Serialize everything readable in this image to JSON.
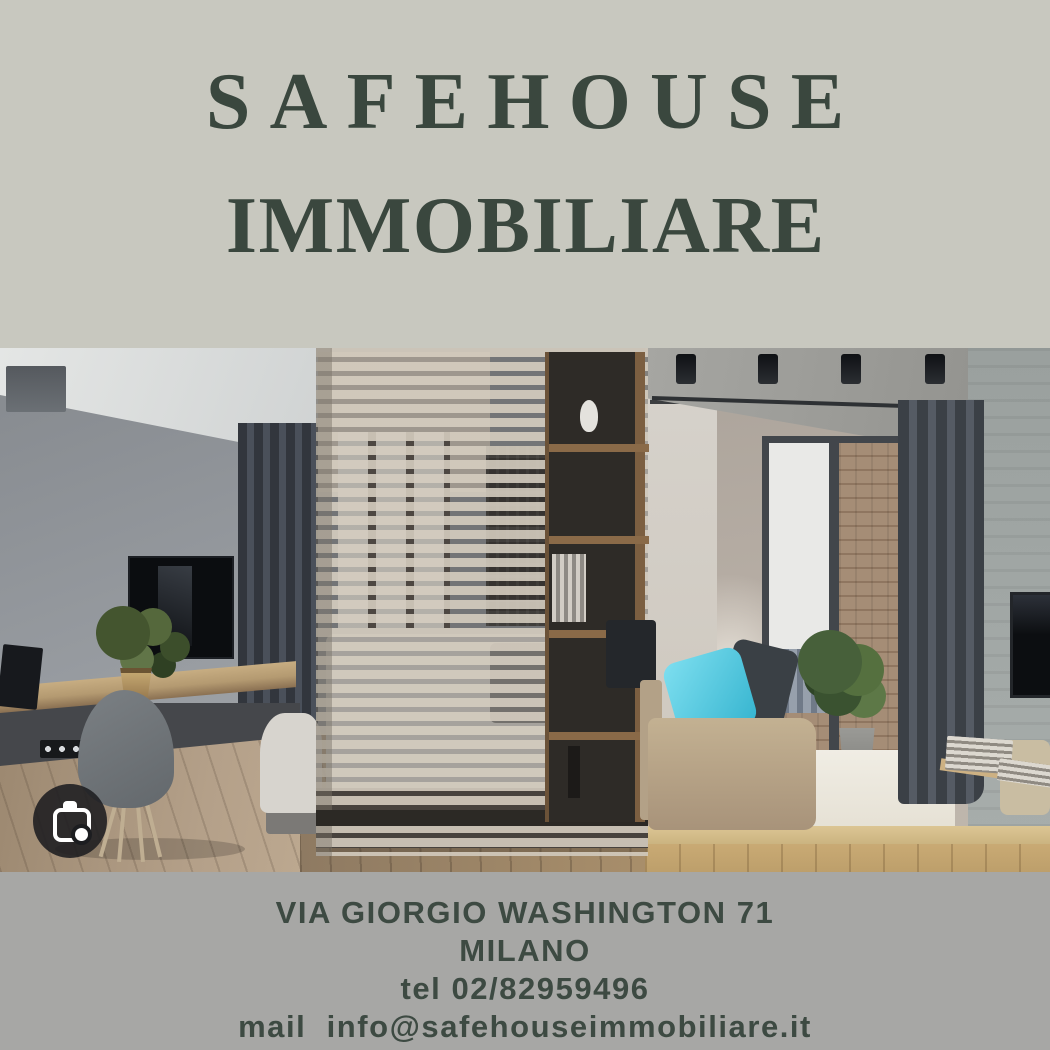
{
  "flyer": {
    "title": {
      "line1": "SAFEHOUSE",
      "line2": "IMMOBILIARE"
    },
    "contact": {
      "address": "VIA GIORGIO WASHINGTON 71",
      "city": "MILANO",
      "phone": "tel 02/82959496",
      "email": "mail  info@safehouseimmobiliare.it"
    },
    "colors": {
      "top_background": "#c8c8bf",
      "bottom_background": "#a7a7a5",
      "title_text": "#3a473e",
      "contact_text": "#3d4a42",
      "pillow_accent": "#4cc4de"
    },
    "photo": {
      "alt": "Modern studio apartment interior: gray wall with TV and floating wooden desk, slatted wood room divider with bed behind it, dark shelf column, beige daybed with turquoise pillow, balcony glass door with brick wall and city view, dark curtains, wooden floor",
      "overlay_icon": "google-lens-camera-icon"
    }
  }
}
